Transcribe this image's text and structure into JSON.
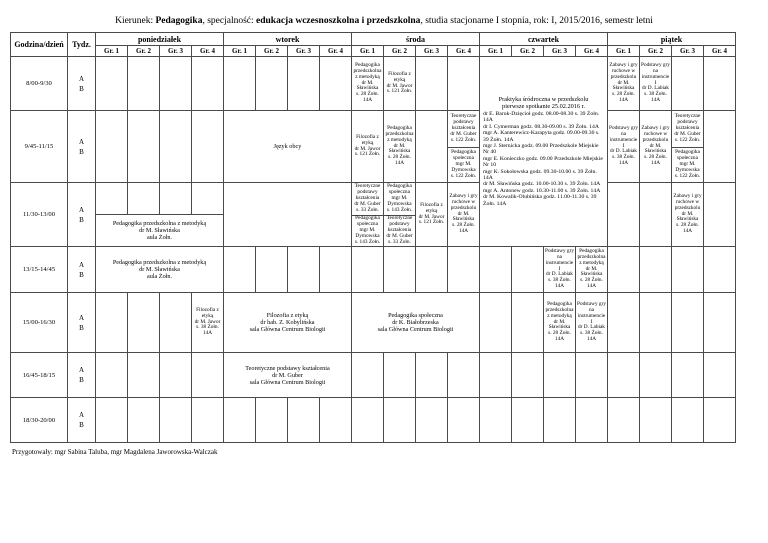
{
  "page_title": {
    "prefix": "Kierunek: ",
    "major": "Pedagogika",
    "separator1": ", specjalność: ",
    "specialty": "edukacja wczesnoszkolna i przedszkolna",
    "suffix": ", studia stacjonarne I stopnia, rok: I, 2015/2016, semestr letni"
  },
  "table": {
    "corner": "Godzina/dzień",
    "week_col": "Tydz.",
    "days": [
      "poniedziałek",
      "wtorek",
      "środa",
      "czwartek",
      "piątek"
    ],
    "groups": [
      "Gr. 1",
      "Gr. 2",
      "Gr. 3",
      "Gr. 4"
    ],
    "week_a": "A",
    "week_b": "B",
    "times": [
      "8/00-9/30",
      "9/45-11/15",
      "11/30-13/00",
      "13/15-14/45",
      "15/00-16/30",
      "16/45-18/15",
      "18/30-20/00"
    ]
  },
  "cells": {
    "pedagogika_przedszkolna_28": "Pedagogika przedszkolna z metodyką\ndr M. Sławińska\ns. 28 Żołn. 14A",
    "filozofia_etyka_121": "Filozofia z etyką\ndr M. Jawor\ns. 121 Żołn.",
    "zabawy_gry_28": "Zabawy i gry ruchowe w przedszkolu\ndr M. Sławińska\ns. 28 Żołn. 14A",
    "podstawy_gry_38": "Podstawy gry na instrumencie I\ndr D. Labiak\ns. 38 Żołn. 14A",
    "jezyk_obcy": "Język obcy",
    "teoretyczne_122": "Teoretyczne podstawy kształcenia\ndr M. Guber\ns. 122 Żołn.",
    "ped_spoleczna_122": "Pedagogika społeczna\nmgr M. Dymowska\ns. 122 Żołn.",
    "teoretyczne_33": "Teoretyczne podstawy kształcenia\ndr M. Guber s. 33 Żołn.",
    "ped_spoleczna_143": "Pedagogika społeczna\nmgr M. Dymowska\ns. 143 Żołn.",
    "ped_przedszkolna_aula": "Pedagogika przedszkolna z metodyką\ndr M. Sławińska\naula Żołn.",
    "filozofia_etyka_38": "Filozofia z etyką\ndr M. Jawor\ns. 38 Żołn. 14A",
    "filozofia_biologia": "Filozofia z etyką\ndr hab. Z. Kobylińska\nsala Główna Centrum Biologii",
    "ped_spoleczna_biologia": "Pedagogika społeczna\ndr K. Białobrzeska\nsala Główna Centrum Biologii",
    "teoretyczne_biologia": "Teoretyczne podstawy kształcenia\ndr M. Guber\nsala Główna Centrum Biologii"
  },
  "praktyka": {
    "title": "Praktyka śródroczna w przedszkolu",
    "subtitle": "pierwsze spotkanie 25.02.2016 r.",
    "entries": [
      "dr E. Baruk-Dzięcioł godz. 08.00-08.30 s. 39 Żołn. 14A",
      "dr I. Cymerman godz. 08.30-09.00 s. 39 Żołn. 14A",
      "mgr A. Kanterewicz-Karapyta godz. 09.00-09.30 s. 39 Żołn. 14A",
      "mgr J. Sternicka godz. 09.00 Przedszkole Miejskie Nr 40",
      "mgr E. Konieczko godz. 09.00 Przedszkole Miejskie Nr 10",
      "mgr K. Sokołowska godz. 09.30-10.00 s. 39 Żołn. 14A",
      "dr M. Sławińska godz. 10.00-10.30 s. 39 Żołn. 14A",
      "mgr A. Antonew godz. 10.30-11.00 s. 39 Żołn. 14A",
      "dr M. Kowalik-Olubińska godz. 11.00-11.30 s. 39 Żołn. 14A"
    ]
  },
  "footer": "Przygotowały: mgr Sabina Taluba, mgr Magdalena Jaworowska-Walczak",
  "colors": {
    "border": "#4a4a4a",
    "text": "#000000",
    "background": "#ffffff"
  }
}
